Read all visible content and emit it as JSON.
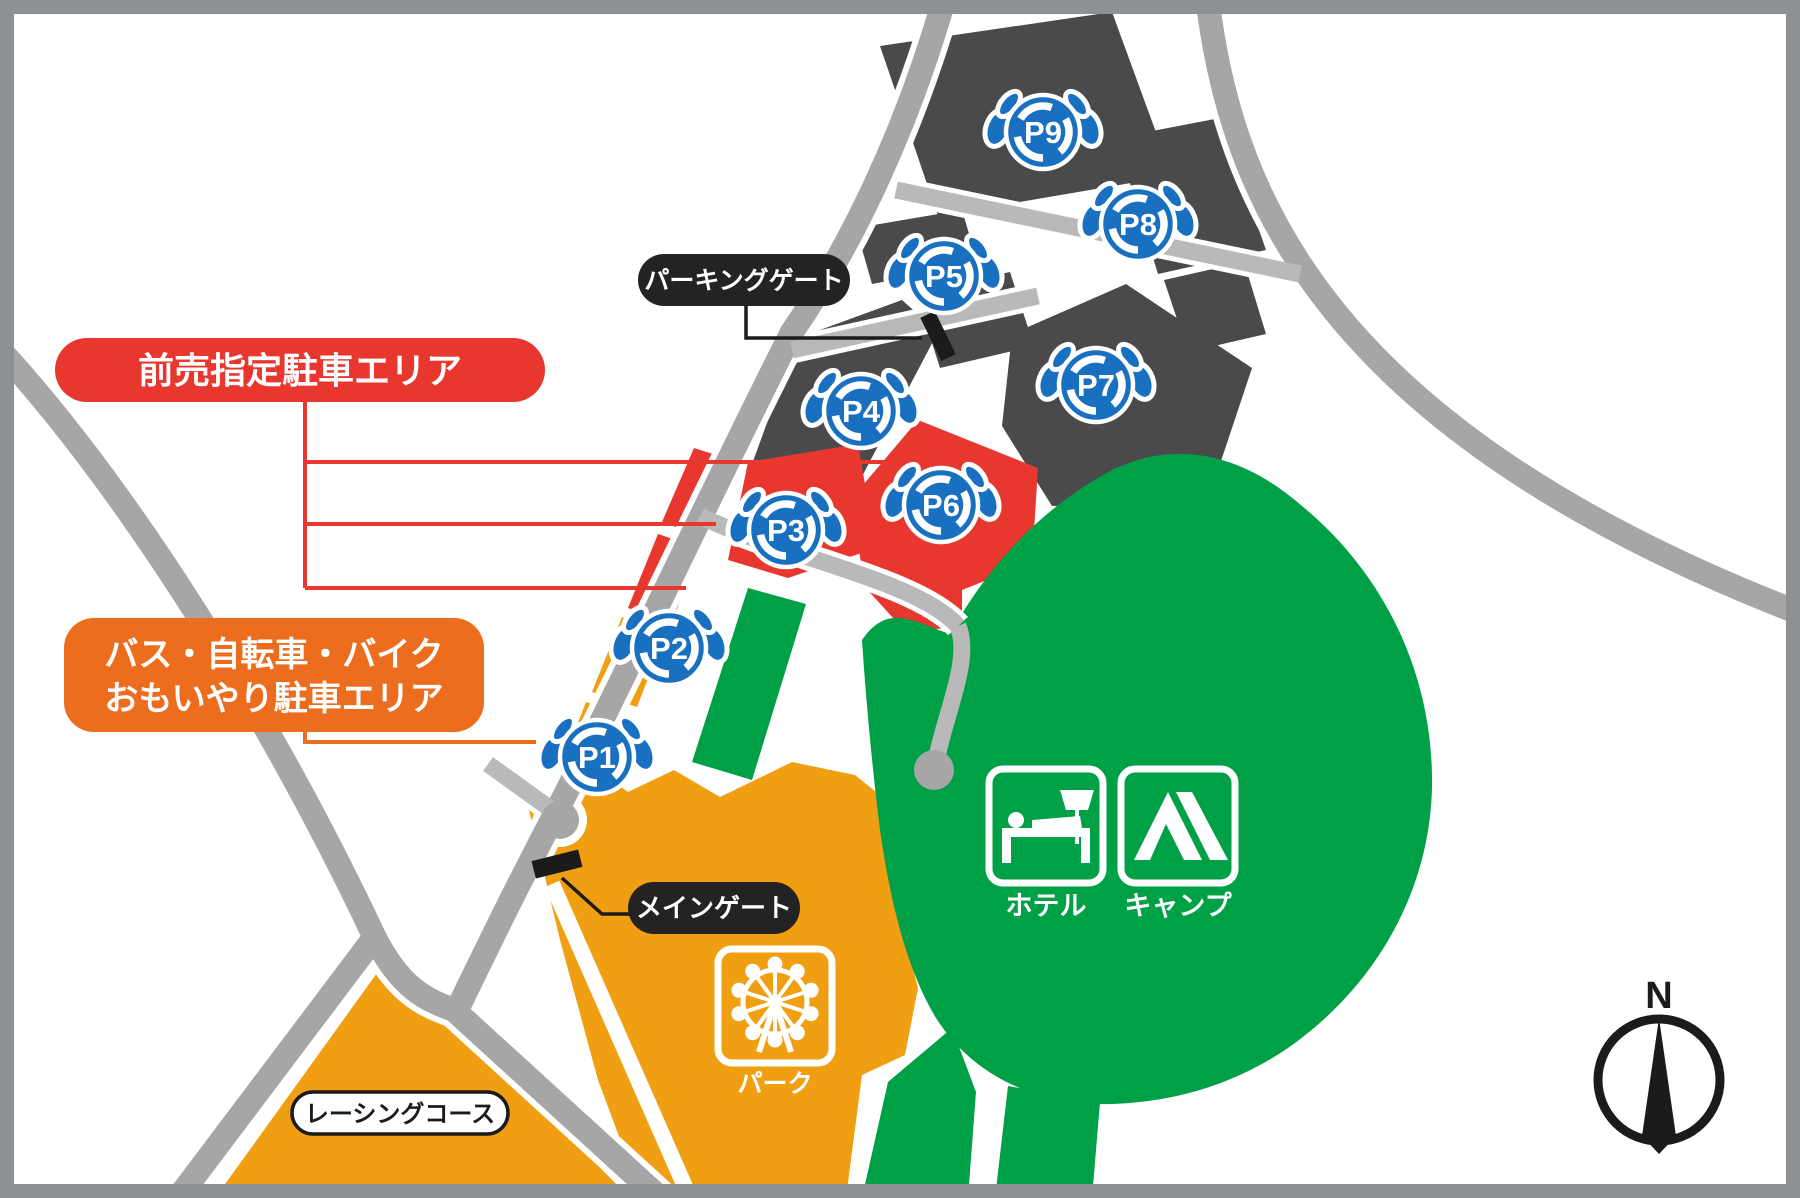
{
  "map_labels": {
    "advance_area": "前売指定駐車エリア",
    "bus_area_line1": "バス・自転車・バイク",
    "bus_area_line2": "おもいやり駐車エリア",
    "parking_gate": "パーキングゲート",
    "main_gate": "メインゲート",
    "racing_course": "レーシングコース"
  },
  "facilities": {
    "hotel": "ホテル",
    "camp": "キャンプ",
    "park": "パーク"
  },
  "parking_areas": [
    {
      "label": "P1"
    },
    {
      "label": "P2"
    },
    {
      "label": "P3"
    },
    {
      "label": "P4"
    },
    {
      "label": "P5"
    },
    {
      "label": "P6"
    },
    {
      "label": "P7"
    },
    {
      "label": "P8"
    },
    {
      "label": "P9"
    }
  ],
  "compass": {
    "north": "N"
  },
  "colors": {
    "advance_red": "#e8372e",
    "bus_orange": "#ed6d1f",
    "area_orange": "#f09f13",
    "area_green": "#00a047",
    "lot_dark": "#4a4a4c",
    "badge_blue": "#1a70c0",
    "road_gray": "#a6a6a6"
  }
}
